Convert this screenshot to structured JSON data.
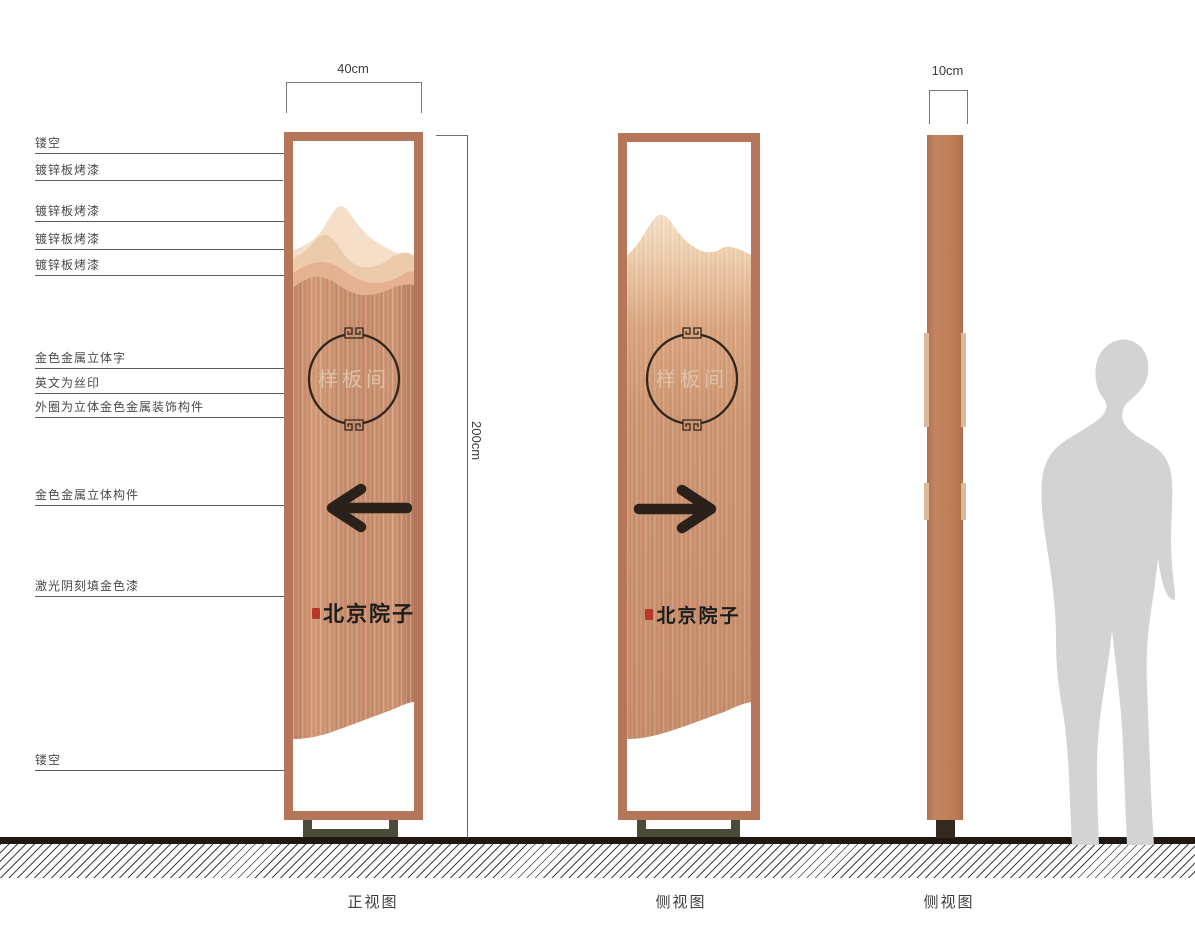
{
  "callouts": [
    {
      "text": "镂空"
    },
    {
      "text": "镀锌板烤漆"
    },
    {
      "text": "镀锌板烤漆"
    },
    {
      "text": "镀锌板烤漆"
    },
    {
      "text": "镀锌板烤漆"
    },
    {
      "text": "金色金属立体字"
    },
    {
      "text": "英文为丝印"
    },
    {
      "text": "外圈为立体金色金属装饰构件"
    },
    {
      "text": "金色金属立体构件"
    },
    {
      "text": "激光阴刻填金色漆"
    },
    {
      "text": "镂空"
    }
  ],
  "dimensions": {
    "front_width": "40cm",
    "height": "200cm",
    "side_width": "10cm"
  },
  "sign": {
    "plate_text": "样板间",
    "brand_text": "北京院子"
  },
  "view_labels": [
    "正视图",
    "侧视图",
    "侧视图"
  ],
  "colors": {
    "frame_copper": "#b5765a",
    "panel_copper": "#c88e6d",
    "mountain_light": "#f5dfc9",
    "mountain_mid": "#eccbab",
    "mountain_deep": "#e5b291",
    "plate_text_color": "#dcc3a8",
    "ink": "#2a211b",
    "seal_red": "#b5382b",
    "base_olive": "#4c4a38",
    "side_base": "#33291f",
    "ground": "#1d1812",
    "person_gray": "#d3d3d3"
  }
}
